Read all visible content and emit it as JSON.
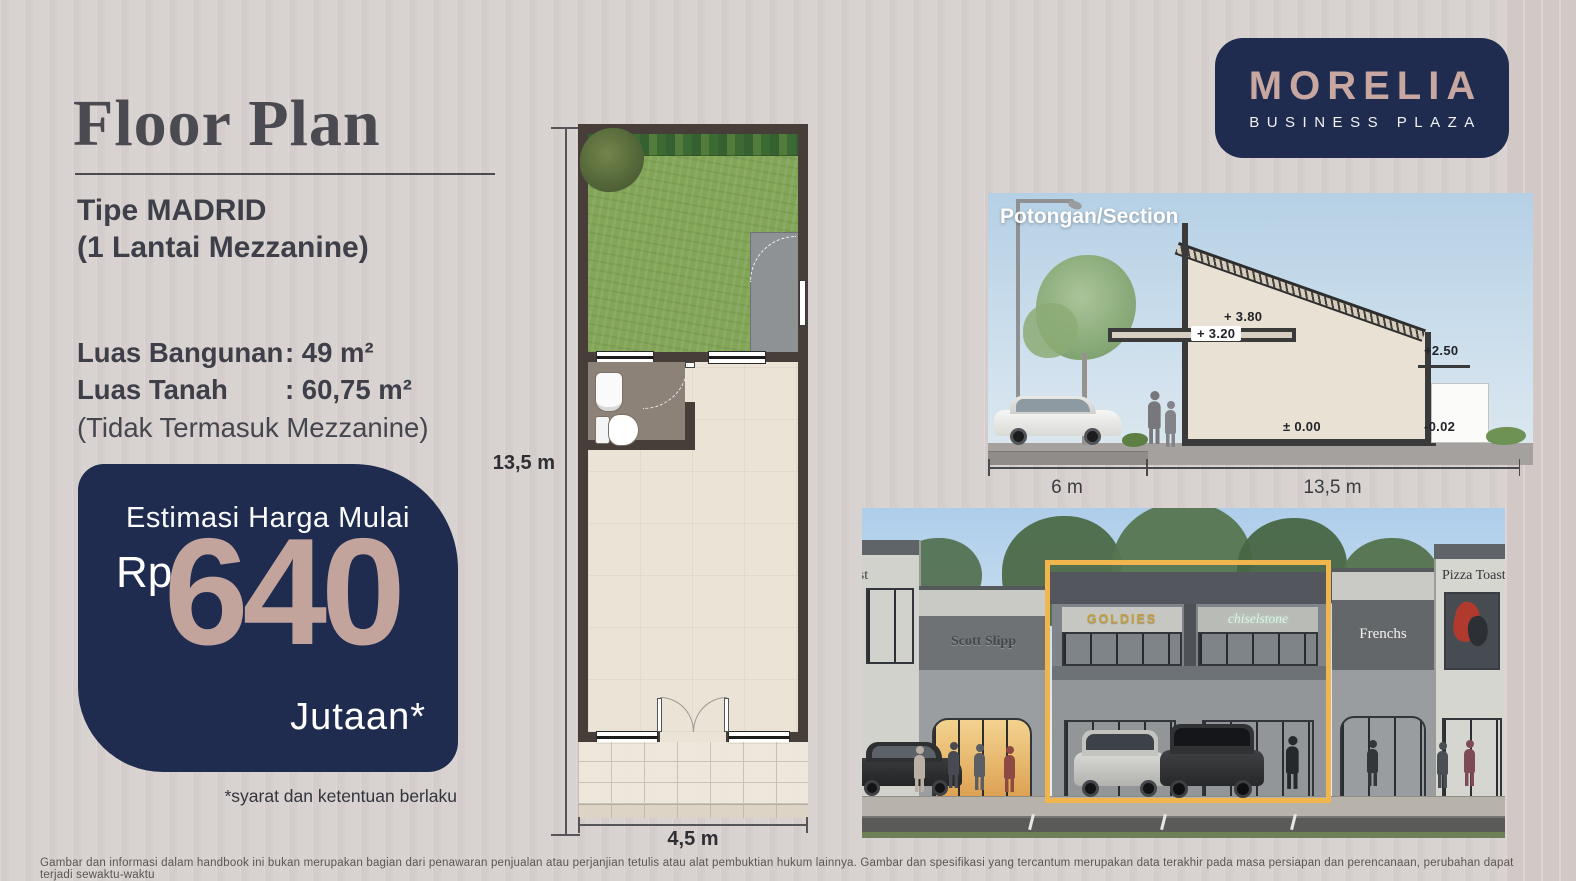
{
  "page": {
    "title": "Floor Plan",
    "disclaimer": "Gambar dan informasi dalam handbook ini bukan merupakan bagian dari penawaran penjualan atau perjanjian tetulis atau alat pembuktian hukum lainnya. Gambar dan spesifikasi yang tercantum merupakan data terakhir pada masa persiapan dan perencanaan, perubahan dapat terjadi sewaktu-waktu"
  },
  "logo": {
    "name": "MORELIA",
    "subtitle": "BUSINESS PLAZA"
  },
  "unit": {
    "type_label": "Tipe MADRID",
    "type_sub": "(1 Lantai Mezzanine)",
    "specs": [
      {
        "label": "Luas Bangunan",
        "value": ": 49 m²"
      },
      {
        "label": "Luas Tanah",
        "value": ": 60,75 m²"
      }
    ],
    "note": "(Tidak Termasuk Mezzanine)"
  },
  "price": {
    "heading": "Estimasi Harga Mulai",
    "currency": "Rp",
    "amount": "640",
    "unit": "Jutaan*",
    "terms": "*syarat dan ketentuan berlaku"
  },
  "floorplan": {
    "height_label": "13,5 m",
    "width_label": "4,5 m"
  },
  "section": {
    "title": "Potongan/Section",
    "level_mezz_top": "+ 3.80",
    "level_mezz": "+ 3.20",
    "level_rear": "+2.50",
    "level_ground": "± 0.00",
    "level_rear_floor": "-0.02",
    "dim_street": "6 m",
    "dim_building": "13,5 m"
  },
  "render": {
    "sign_toast": "Toast",
    "sign_scott": "Scott Slipp",
    "sign_goldies": "GOLDIES",
    "sign_chisel": "chiselstone",
    "sign_frenchs": "Frenchs",
    "sign_pizza": "Pizza Toast"
  },
  "colors": {
    "navy": "#1f2c50",
    "mauve": "#c3a49d",
    "highlight_yellow": "#f0b54d",
    "background": "#d8d2d1"
  }
}
